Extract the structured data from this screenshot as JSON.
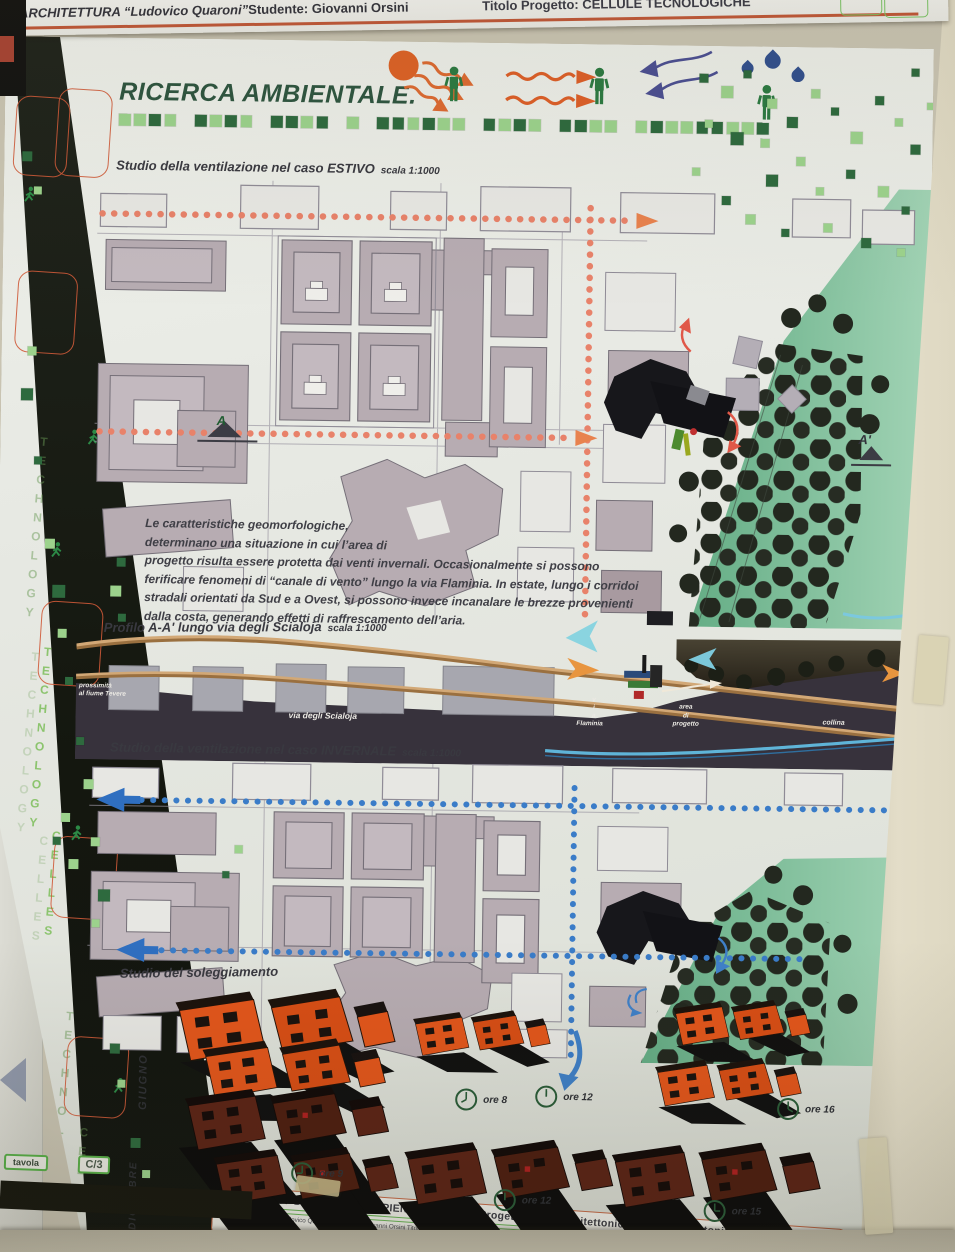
{
  "header": {
    "faculty": "I ARCHITETTURA “Ludovico Quaroni”",
    "student": "Studente: Giovanni Orsini",
    "project": "Titolo Progetto: CELLULE TECNOLOGICHE",
    "corner_code": "D/1"
  },
  "side_band": {
    "word_top": "TECHNOLOGY",
    "word_main": "TECHNOLOGY",
    "word_main2": "CELLES",
    "word_bottom": "TECHNOLOGY",
    "word_bottom2": "CELLES"
  },
  "badges": {
    "bottom_left_label": "tavola",
    "bottom_left_code": "C/3",
    "footer_label": "TAVOLA",
    "footer_code": "D/1"
  },
  "poster": {
    "title": "RICERCA AMBIENTALE.",
    "section_estivo_label": "Studio della ventilazione nel caso ESTIVO",
    "section_estivo_scale": "scala 1:1000",
    "paragraph_lines": [
      "Le caratteristiche geomorfologiche,",
      "determinano una situazione in cui l’area di",
      "progetto risulta essere protetta dai venti invernali. Occasionalmente si possono",
      "ferificare fenomeni di “canale di vento” lungo la via Flaminia. In estate, lungo i corridoi",
      "stradali orientati da Sud e a Ovest, si possono invece incanalare le brezze provenienti",
      "dalla costa, generando effetti di raffrescamento dell’aria."
    ],
    "section_profilo_label": "Profilo A-A' lungo via degli Scialoja",
    "section_profilo_scale": "scala 1:1000",
    "profile_labels": {
      "tevere_1": "prossimità",
      "tevere_2": "al fiume Tevere",
      "scialoja": "via degli Scialoja",
      "flaminia_v": "v",
      "flaminia_i": "i",
      "flaminia_a": "a",
      "flaminia_name": "Flaminia",
      "area_1": "area",
      "area_2": "di",
      "area_3": "progetto",
      "collina": "collina"
    },
    "section_invernale_label": "Studio della ventilazione nel caso INVERNALE",
    "section_invernale_scale": "scala 1:1000",
    "section_sole_label": "Studio del soleggiamento",
    "marker_a": "A",
    "marker_a1": "A'",
    "month_june": "GIUGNO",
    "month_december": "DICEMBRE",
    "clock_june": [
      "ore 8",
      "ore 12",
      "ore 16"
    ],
    "clock_december": [
      "ore 9",
      "ore 12",
      "ore 15"
    ]
  },
  "footer": {
    "line1": "UNIVERSITA' DI ROMA “LA SAPIENZA”    Corso di Progettazione Architettonica IV D.  Prof. Antonino Saggio",
    "line2": "DI ARCHITETTURA “Ludovico Quaroni”   Studente: Giovanni Orsini   Titolo Progetto: Cellule Tecnologiche   Moduli Impianti C. Natocchiani   Modulo di Tecnologia Moduli"
  },
  "colors": {
    "accent_orange": "#c05838",
    "green_dark": "#2e6a3e",
    "green_light": "#9cd28c",
    "dot_summer": "#e8826a",
    "dot_winter": "#3a7cc8",
    "building_fill": "#b7acb2",
    "park_green": "#74b895",
    "june_orange": "#e3561b",
    "december_brown": "#5c2416"
  },
  "icons": {
    "sun-icon": "orange disc with wavy arrows",
    "person-icon": "standing green figure",
    "runner-icon": "green walking figure",
    "raindrop-icon": "blue drop",
    "clock-icon": "outlined clock face",
    "triangle-marker": "▲"
  }
}
